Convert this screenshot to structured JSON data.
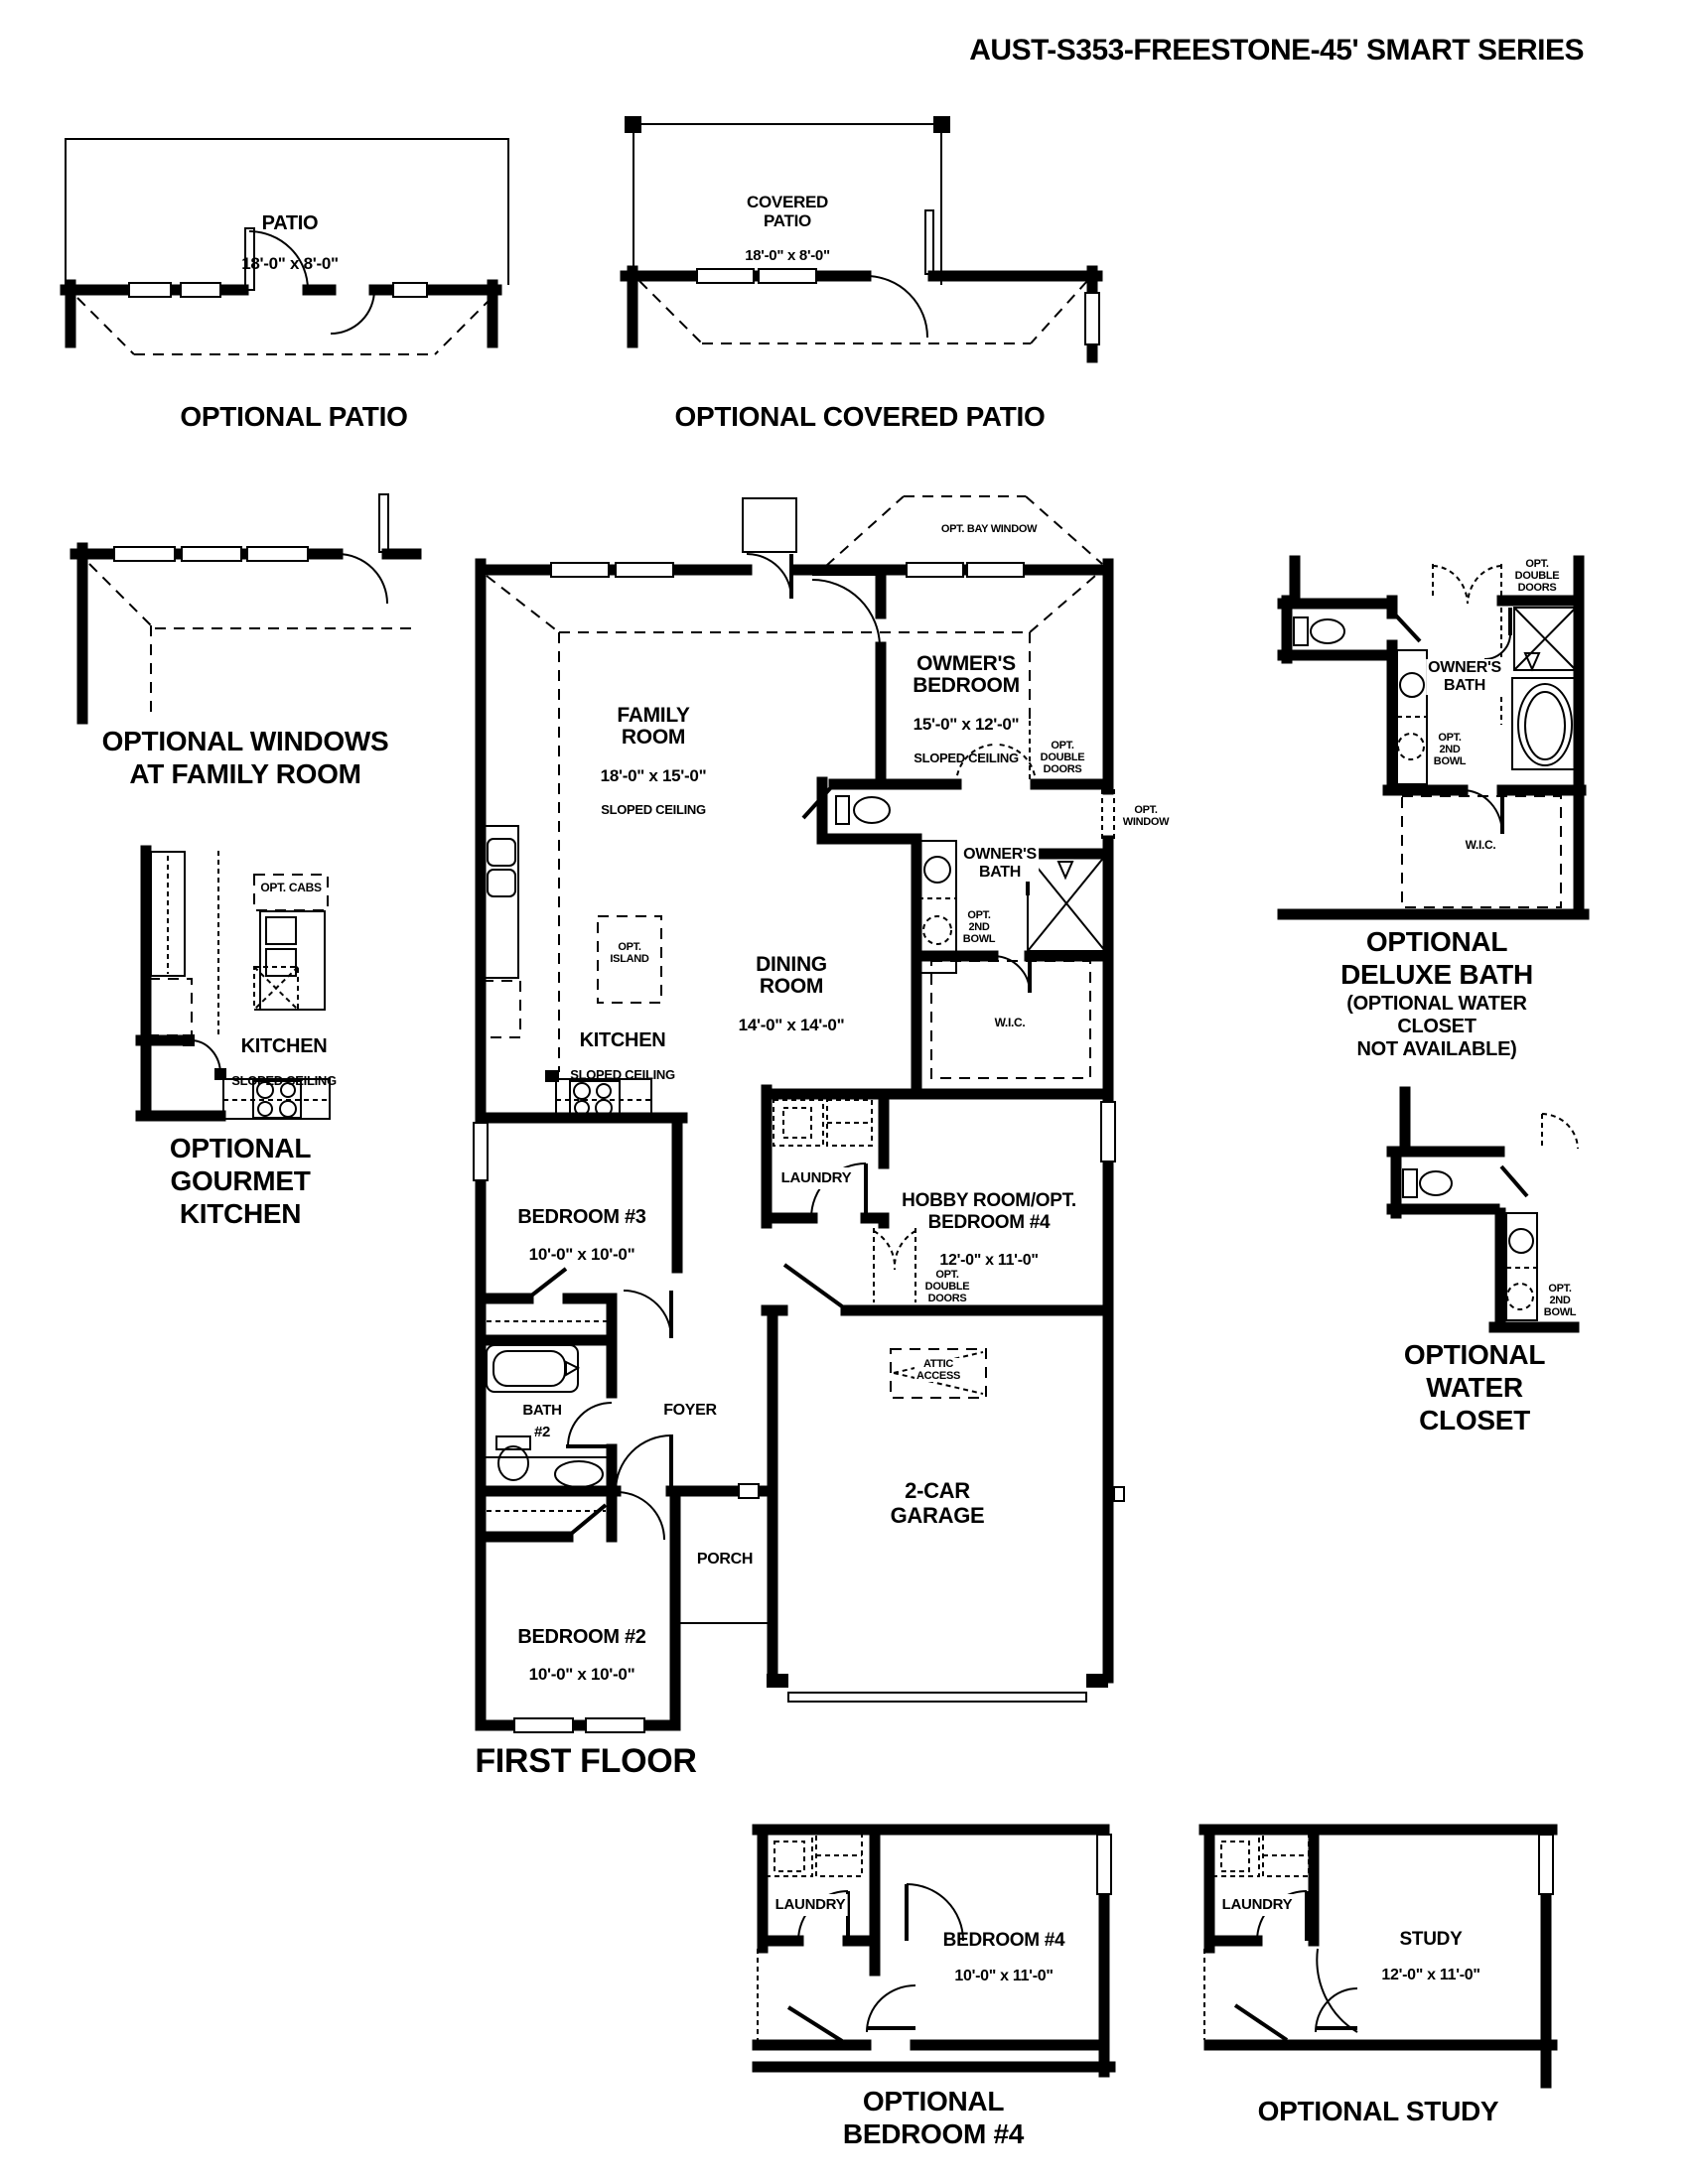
{
  "title": "AUST-S353-FREESTONE-45' SMART SERIES",
  "labels": {
    "patio": {
      "name": "PATIO",
      "dims": "18'-0\" x 8'-0\""
    },
    "covered_patio": {
      "name": "COVERED\nPATIO",
      "dims": "18'-0\" x 8'-0\""
    },
    "family": {
      "name": "FAMILY\nROOM",
      "dims": "18'-0\" x 15'-0\"",
      "note": "SLOPED CEILING"
    },
    "owners_bedroom": {
      "name": "OWMER'S\nBEDROOM",
      "dims": "15'-0\" x 12'-0\"",
      "note": "SLOPED CEILING"
    },
    "dining": {
      "name": "DINING\nROOM",
      "dims": "14'-0\" x 14'-0\""
    },
    "kitchen": {
      "name": "KITCHEN",
      "note": "SLOPED CEILING"
    },
    "hobby": {
      "name": "HOBBY ROOM/OPT.\nBEDROOM #4",
      "dims": "12'-0\" x 11'-0\""
    },
    "bedroom2": {
      "name": "BEDROOM #2",
      "dims": "10'-0\" x 10'-0\""
    },
    "bedroom3": {
      "name": "BEDROOM #3",
      "dims": "10'-0\" x 10'-0\""
    },
    "bedroom4": {
      "name": "BEDROOM #4",
      "dims": "10'-0\" x 11'-0\""
    },
    "study": {
      "name": "STUDY",
      "dims": "12'-0\" x 11'-0\""
    },
    "garage": "2-CAR\nGARAGE",
    "owners_bath": "OWNER'S\nBATH",
    "bath2": "BATH\n#2",
    "foyer": "FOYER",
    "porch": "PORCH",
    "laundry": "LAUNDRY",
    "wic": "W.I.C.",
    "attic": "ATTIC\nACCESS",
    "opt_island": "OPT.\nISLAND",
    "opt_cabs": "OPT. CABS",
    "opt_bay_window": "OPT. BAY WINDOW",
    "opt_double_doors": "OPT.\nDOUBLE\nDOORS",
    "opt_window": "OPT.\nWINDOW",
    "opt_2nd_bowl": "OPT.\n2ND\nBOWL"
  },
  "captions": {
    "patio": "OPTIONAL PATIO",
    "covered_patio": "OPTIONAL  COVERED PATIO",
    "windows_family": "OPTIONAL WINDOWS\nAT FAMILY ROOM",
    "gourmet": "OPTIONAL\nGOURMET\nKITCHEN",
    "first_floor": "FIRST FLOOR",
    "deluxe_bath_main": "OPTIONAL\nDELUXE BATH",
    "deluxe_bath_sub": "(OPTIONAL WATER CLOSET\nNOT AVAILABLE)",
    "water_closet": "OPTIONAL\nWATER CLOSET",
    "bedroom4": "OPTIONAL\nBEDROOM #4",
    "study": "OPTIONAL STUDY"
  }
}
